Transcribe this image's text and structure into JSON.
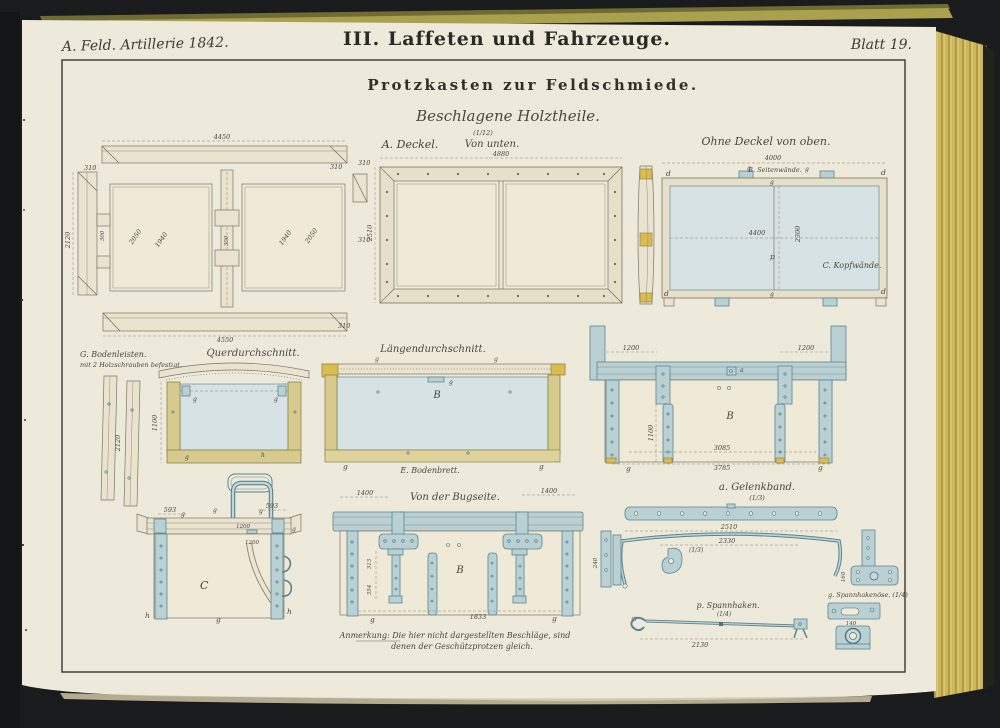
{
  "book": {
    "series": "A. Feld. Artillerie 1842.",
    "title": "III. Laffeten und Fahrzeuge.",
    "sheet": "Blatt 19."
  },
  "plate": {
    "title": "Protzkasten zur Feldschmiede.",
    "subtitle": "Beschlagene Holztheile.",
    "scale": "(1/12)"
  },
  "glyphs": {
    "B": "B",
    "C": "C",
    "d": "d",
    "g": "g",
    "h": "h",
    "p": "p",
    "a": "a"
  },
  "fig_lid_exploded": {
    "dim_top": "4450",
    "dim_end": "310",
    "dim_bottom": "4550",
    "dim_height": "2120",
    "dim_panel_a": "2050",
    "dim_panel_b": "1940",
    "dim_notch": "300"
  },
  "fig_lid_bottom": {
    "part": "A. Deckel.",
    "view": "Von unten.",
    "dim_width": "4880",
    "dim_edge": "310",
    "dim_height": "2510",
    "dim_side": "310"
  },
  "fig_box_top": {
    "title": "Ohne Deckel von oben.",
    "side_label": "B. Seitenwände.",
    "head_label": "C. Kopfwände.",
    "dim_width": "4000",
    "dim_inner_width": "4400",
    "dim_inner_height": "2300"
  },
  "fig_bodenleisten": {
    "label": "G. Bodenleisten.",
    "note": "mit 2 Holzschrauben befestigt.",
    "dim_length": "2120"
  },
  "fig_querschnitt": {
    "title": "Querdurchschnitt.",
    "dim_height": "1100"
  },
  "fig_laengsschnitt": {
    "title": "Längendurchschnitt.",
    "bottom_label": "E. Bodenbrett."
  },
  "fig_seitenansicht": {
    "dim_left": "1200",
    "dim_right": "1200",
    "dim_strap": "1100",
    "dim_inner": "3085",
    "dim_outer": "3785"
  },
  "fig_kopfansicht": {
    "dim_left": "593",
    "dim_right": "593",
    "dim_rim": "1200",
    "dim_handle": "1200"
  },
  "fig_bugseite": {
    "title": "Von der Bugseite.",
    "dim_left": "1400",
    "dim_right": "1400",
    "dim_a": "313",
    "dim_b": "354",
    "dim_bottom": "1833"
  },
  "fig_gelenkband": {
    "title": "a. Gelenkband.",
    "scale": "(1/3)",
    "hook_scale": "(1/3)",
    "dim_upper": "2510",
    "dim_lower": "2330",
    "dim_small": "240"
  },
  "fig_oese": {
    "label": "g. Spannhakenöse. (1/4)",
    "dim": "160"
  },
  "fig_spannhaken": {
    "title": "p. Spannhaken.",
    "scale": "(1/4)",
    "dim_length": "2130",
    "dim_plate": "140"
  },
  "note": {
    "line1": "Anmerkung: Die hier nicht dargestellten Beschläge, sind",
    "line2": "denen der Geschützprotzen gleich."
  },
  "colors": {
    "background": "#1a1c1d",
    "paper": "#edeadc",
    "page_edge_gold": "#cdb75d",
    "iron_fill": "#b9d1d5",
    "iron_stroke": "#5d848d",
    "panel_blue": "#d6e2e4",
    "wood_yellow": "#d6cb8c",
    "highlight_yellow": "#d9bd4e",
    "ink": "#4a443a"
  }
}
